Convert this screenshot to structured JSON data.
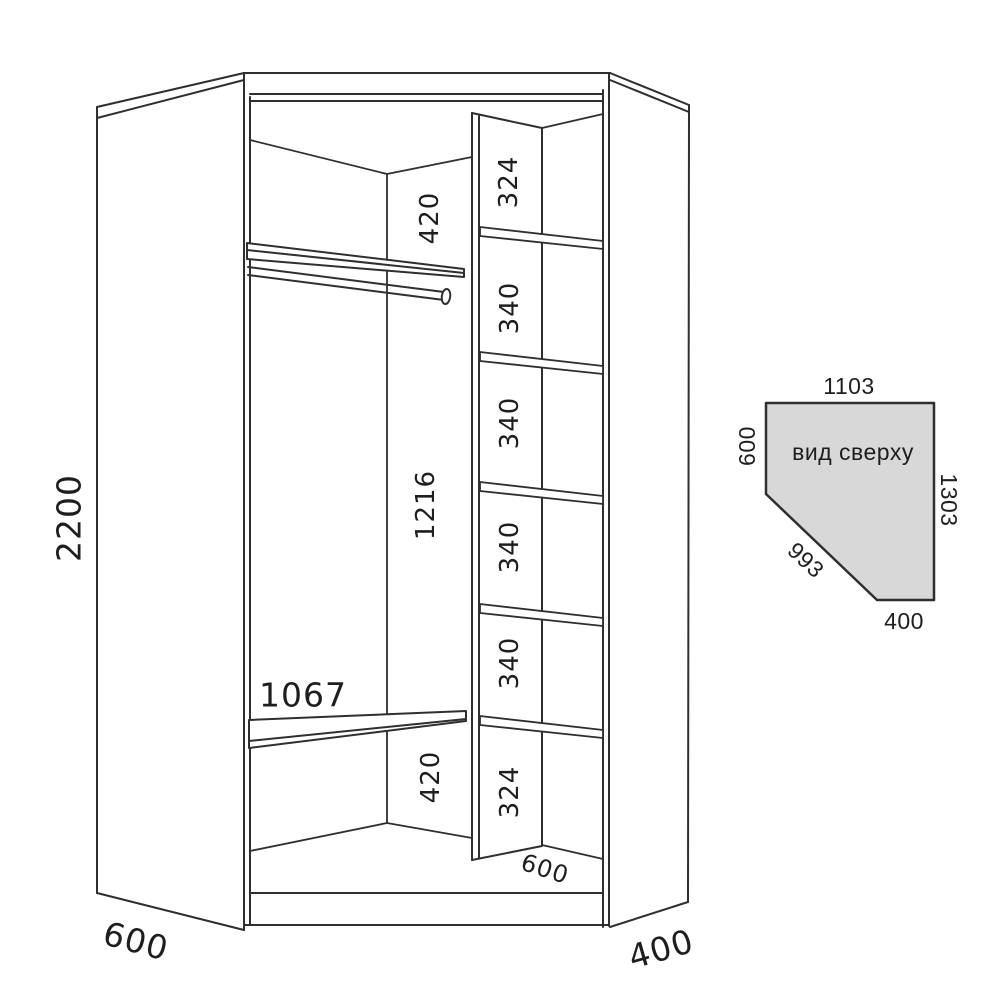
{
  "colors": {
    "line": "#2f2f2f",
    "text": "#1e1e1e",
    "top_view_fill": "#d8d8d8",
    "background": "#ffffff"
  },
  "main_view": {
    "height": "2200",
    "left_width": "600",
    "right_width": "400",
    "top_section": "420",
    "hanging_section": "1216",
    "lower_shelf_length": "1067",
    "bottom_section": "420",
    "column_depth": "600",
    "column_sections": [
      "324",
      "340",
      "340",
      "340",
      "340",
      "324"
    ]
  },
  "top_view": {
    "caption": "вид сверху",
    "back_width": "1103",
    "left_depth": "600",
    "right_depth": "1303",
    "front_width": "993",
    "right_return": "400",
    "fill_color": "#d8d8d8"
  }
}
